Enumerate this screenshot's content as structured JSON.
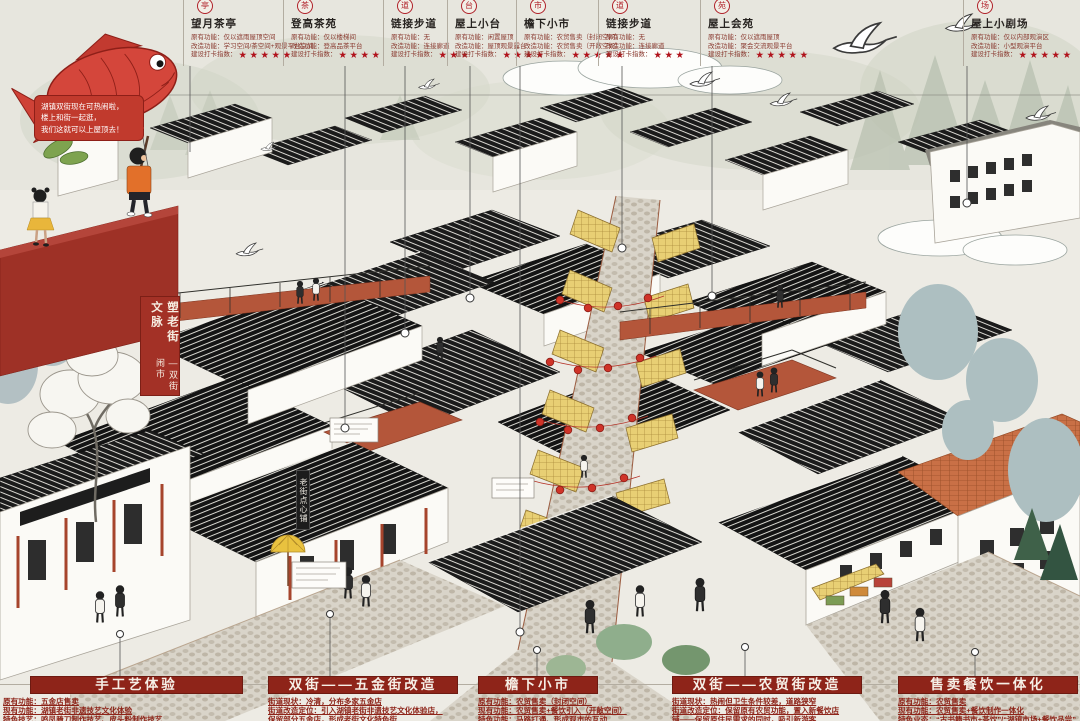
{
  "story": {
    "bubble_lines": [
      "湖镇双街现在可热闹啦，",
      "楼上和街一起逛，",
      "我们这就可以上屋顶去！"
    ],
    "banner_main": "塑老街文脉",
    "banner_sub": "—双街闹市",
    "shop_sign": "老街点心铺"
  },
  "callouts": [
    {
      "icon": "亭",
      "title": "望月茶亭",
      "rows": [
        "原有功能：仅以遮雨屋顶空间",
        "改造功能：学习空间/茶空间+观景平台空间"
      ],
      "stars_label": "建设打卡指数：",
      "stars": 5
    },
    {
      "icon": "茶",
      "title": "登高茶苑",
      "rows": [
        "原有功能：仅以楼梯间",
        "改造功能：登高品茶平台"
      ],
      "stars_label": "建设打卡指数：",
      "stars": 4
    },
    {
      "icon": "道",
      "title": "链接步道",
      "rows": [
        "原有功能：无",
        "改造功能：连接廊道"
      ],
      "stars_label": "建设打卡指数：",
      "stars": 3
    },
    {
      "icon": "台",
      "title": "屋上小台",
      "rows": [
        "原有功能：闲置屋顶",
        "改造功能：屋顶观景露台"
      ],
      "stars_label": "建设打卡指数：",
      "stars": 4
    },
    {
      "icon": "市",
      "title": "檐下小市",
      "rows": [
        "原有功能：农贸售卖（封闭空间）",
        "改造功能：农贸售卖（开敞空间）"
      ],
      "stars_label": "建设打卡指数：",
      "stars": 5
    },
    {
      "icon": "道",
      "title": "链接步道",
      "rows": [
        "原有功能：无",
        "改造功能：连接廊道"
      ],
      "stars_label": "建设打卡指数：",
      "stars": 3
    },
    {
      "icon": "苑",
      "title": "屋上会苑",
      "rows": [
        "原有功能：仅以遮雨屋顶",
        "改造功能：聚会交流观景平台"
      ],
      "stars_label": "建设打卡指数：",
      "stars": 5
    },
    {
      "icon": "场",
      "title": "屋上小剧场",
      "rows": [
        "原有功能：仅以内部观演区",
        "改造功能：小型观演平台"
      ],
      "stars_label": "建设打卡指数：",
      "stars": 5
    }
  ],
  "sections": [
    {
      "title": "手工艺体验",
      "lines": [
        "原有功能：五金店售卖",
        "现有功能：湖镇老街非遗技艺文化体验",
        "特色技艺：鸣凤腌刀制作技艺、皮头粉制作技艺"
      ]
    },
    {
      "title": "双街——五金街改造",
      "lines": [
        "街道现状：冷清，分布多家五金店",
        "街道改造定位：引入湖镇老街非遗技艺文化体验店，",
        "保留部分五金店，形成老街文化特色街"
      ]
    },
    {
      "title": "檐下小市",
      "lines": [
        "原有功能：农贸售卖（封闭空间）",
        "现有功能：农贸售卖+餐饮引入（开敞空间）",
        "特色功能：马路打通、形成观市的互动"
      ]
    },
    {
      "title": "双街——农贸街改造",
      "lines": [
        "街道现状：热闹但卫生条件较差，道路狭窄",
        "街道改造定位：保留原有农贸功能，置入新餐饮店",
        "铺——保留原住民需求的同时，吸引新游客"
      ]
    },
    {
      "title": "售卖餐饮一体化",
      "lines": [
        "原有功能：农贸售卖",
        "现有功能：农贸售卖+餐饮制作一体化",
        "特色业态：“古书籍书市+茶饮”/“湖镇市场+餐饮品尝”"
      ]
    }
  ],
  "colors": {
    "accent_red": "#8e2419",
    "star_red": "#b0121b",
    "lantern": "#cf3328",
    "awning": "#e8cf74",
    "deck": "#b4563a"
  }
}
